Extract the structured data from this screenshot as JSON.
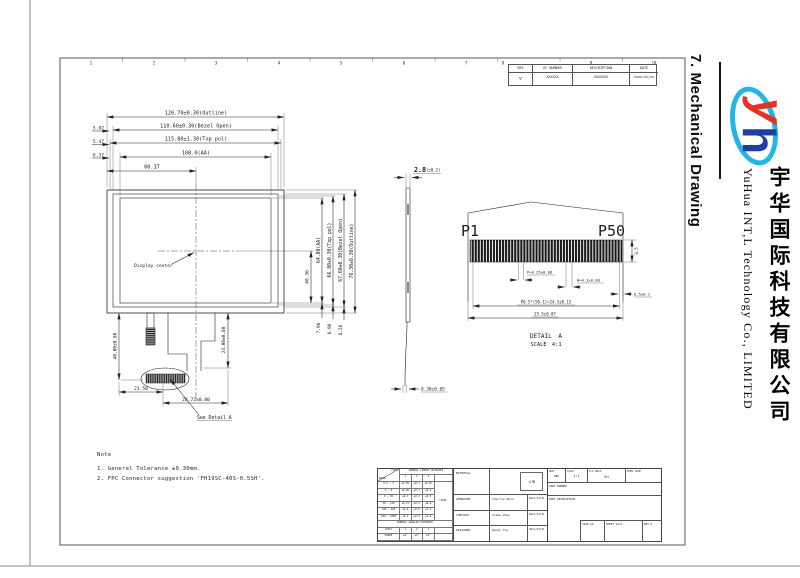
{
  "sheet": {
    "zones": [
      "1",
      "2",
      "3",
      "4",
      "5",
      "6",
      "7",
      "8",
      "9",
      "10"
    ]
  },
  "revision_table": {
    "headers": [
      "REV",
      "EC NUMBER",
      "DESCRIPTION",
      "DATE"
    ],
    "row": {
      "rev": "▽",
      "ec": "XXXXXX",
      "description": "XXXXXXX",
      "date": "xxxx/xx/xx"
    }
  },
  "front_view": {
    "dim_outline_w": "120.70±0.30(Outline)",
    "dim_bezel_w": "110.60±0.30(Bezel Open)",
    "dim_pol_w": "115.80±1.30(Top pol)",
    "dim_aa_w": "108.0(AA)",
    "dim_center_x": "60.37",
    "off_bezel": "5.07",
    "off_pol": "5.47",
    "off_aa": "6.37",
    "display_center": "Display center",
    "dim_center_y": "40.36",
    "dim_aa_h": "64.80(AA)",
    "dim_pol_h": "66.80±0.30(Top pol)",
    "dim_bezel_h": "67.60±0.30(Bezel Open)",
    "dim_outline_h": "76.30±0.30(Outline)",
    "off_b_pol": "7.96",
    "off_b_bezel": "6.96",
    "off_b_outline": "6.56",
    "dim_fpc_drop": "40.00±0.80",
    "dim_fpc_drop2": "24.00±0.80",
    "dim_conn_x1": "21.50",
    "dim_conn_w": "28.72±0.80",
    "see_detail": "See Detail A"
  },
  "side_view": {
    "thickness": "2.8",
    "thickness_tol": "(±0.2)",
    "fpc_thickness": "0.30±0.05"
  },
  "detail_a": {
    "pin_first": "P1",
    "pin_last": "P50",
    "dim_depth": "3.5",
    "dim_gap": "P=0.25±0.08",
    "dim_pad_w": "W=0.3±0.08",
    "dim_edge": "0.5±0.1",
    "dim_pitch": "P0.5*(50-1)=24.5±0.15",
    "dim_total": "25.5±0.07",
    "title": "DETAIL A",
    "scale": "SCALE 4:1"
  },
  "note": {
    "title": "Note",
    "line1": "1. General Tolerance ±0.30mm.",
    "line2": "2. FPC Connector suggestion 'FH19SC-40S-0.5SH'."
  },
  "title_block": {
    "material_label": "MATERIAL",
    "approved": {
      "label": "APPROVED",
      "name": "Charlie Zhou",
      "date": "2011/12/21"
    },
    "checked": {
      "label": "CHECKED",
      "name": "Cosmo Zhou",
      "date": "2011/12/21"
    },
    "designed": {
      "label": "DESIGNED",
      "name": "Karen You",
      "date": "2011/12/21"
    },
    "unit": {
      "label": "UNIT",
      "value": "mm"
    },
    "scale": {
      "label": "SCALE",
      "value": "1:1"
    },
    "angle": {
      "label": "3rd ANGLE"
    },
    "model_name_label": "MODEL NAME",
    "part_number_label": "PART NUMBER",
    "part_description_label": "PART DESCRIPTION",
    "size": {
      "label": "SIZE",
      "value": "A3"
    },
    "sheet": {
      "label": "SHEET",
      "value": "1of1"
    },
    "rev": {
      "label": "REV",
      "value": "0"
    }
  },
  "tolerance_table": {
    "linear_header": "GENERAL LINEAR TOLERANCE",
    "angular_header": "GENERAL ANGULAR TOLERANCE",
    "level_label": "LEVEL",
    "range_label": "RANGE",
    "levels": [
      "1",
      "2",
      "3"
    ],
    "rows": [
      [
        "0.5 ~ 3",
        "±0.05",
        "±0.1",
        "±0.15"
      ],
      [
        "3 ~ 6",
        "±0.05",
        "±0.1",
        "±0.2"
      ],
      [
        "6 ~ 30",
        "±0.1",
        "±0.2",
        "±0.5"
      ],
      [
        "30 ~ 120",
        "±0.15",
        "±0.3",
        "±0.8"
      ],
      [
        "120 ~ 400",
        "±0.2",
        "±0.5",
        "±1.2"
      ],
      [
        "400 ~ 1000",
        "±0.3",
        "±0.8",
        "±2.0"
      ]
    ],
    "angular_values": [
      "±1°",
      "±2°",
      "±3°"
    ]
  },
  "sidebar": {
    "heading": "7. Mechanical Drawing",
    "company_en": "YuHua INT,L Technology Co., LIMITED",
    "company_cn": "宇华国际科技有限公司",
    "logo_colors": {
      "red": "#e53228",
      "blue": "#1c3fa3",
      "cyan": "#22b5e8"
    }
  }
}
